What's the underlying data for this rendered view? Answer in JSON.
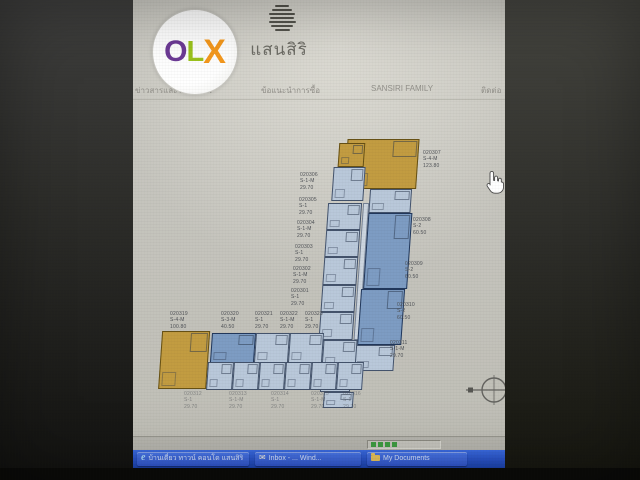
{
  "watermark": {
    "name": "OLX",
    "letters": [
      {
        "char": "O",
        "color": "#6d3a96"
      },
      {
        "char": "L",
        "color": "#9cc41d"
      },
      {
        "char": "X",
        "color": "#f6991d"
      }
    ]
  },
  "site": {
    "brand": "แสนสิริ",
    "nav": [
      {
        "label": "ข่าวสารและโปรโมชั่น"
      },
      {
        "label": "ข้อแนะนำการซื้อ"
      },
      {
        "label": "SANSIRI FAMILY"
      },
      {
        "label": "ติดต่อ"
      }
    ]
  },
  "floorplan": {
    "left_units": [
      {
        "id": "020306",
        "type": "S-1-M",
        "area": "29.70"
      },
      {
        "id": "020305",
        "type": "S-1",
        "area": "29.70"
      },
      {
        "id": "020304",
        "type": "S-1-M",
        "area": "29.70"
      },
      {
        "id": "020303",
        "type": "S-1",
        "area": "29.70"
      },
      {
        "id": "020302",
        "type": "S-1-M",
        "area": "29.70"
      },
      {
        "id": "020301",
        "type": "S-1",
        "area": "29.70"
      }
    ],
    "right_units": [
      {
        "id": "020307",
        "type": "S-4-M",
        "area": "123.80"
      },
      {
        "id": "020308",
        "type": "S-2",
        "area": "60.50"
      },
      {
        "id": "020309",
        "type": "S-2",
        "area": "60.50"
      },
      {
        "id": "020310",
        "type": "S-2",
        "area": "60.50"
      },
      {
        "id": "020311",
        "type": "S-1-M",
        "area": "29.70"
      }
    ],
    "top_units": [
      {
        "id": "020319",
        "type": "S-4-M",
        "area": "100.80"
      },
      {
        "id": "020320",
        "type": "S-3-M",
        "area": "40.50"
      },
      {
        "id": "020321",
        "type": "S-1",
        "area": "29.70"
      },
      {
        "id": "020322",
        "type": "S-1-M",
        "area": "29.70"
      },
      {
        "id": "020323",
        "type": "S-1",
        "area": "29.70"
      }
    ],
    "bottom_units": [
      {
        "id": "020312",
        "type": "S-1",
        "area": "29.70"
      },
      {
        "id": "020313",
        "type": "S-1-M",
        "area": "29.70"
      },
      {
        "id": "020314",
        "type": "S-1",
        "area": "29.70"
      },
      {
        "id": "020315",
        "type": "S-1-M",
        "area": "29.70"
      },
      {
        "id": "020316",
        "type": "S-1",
        "area": "29.70"
      }
    ],
    "unit_colors": {
      "standard": "#b9c8da",
      "two_bed": "#7d9cc3",
      "penthouse": "#c29c41"
    }
  },
  "statusbar": {
    "progress_blocks": 4,
    "progress_color": "#3f9e42"
  },
  "taskbar": {
    "buttons": [
      {
        "icon": "ie-icon",
        "label": "บ้านเดี่ยว ทาวน์ คอนโด แสนสิริ"
      },
      {
        "icon": "mail-icon",
        "label": "Inbox - ... Wind..."
      },
      {
        "icon": "folder-icon",
        "label": "My Documents"
      }
    ]
  }
}
